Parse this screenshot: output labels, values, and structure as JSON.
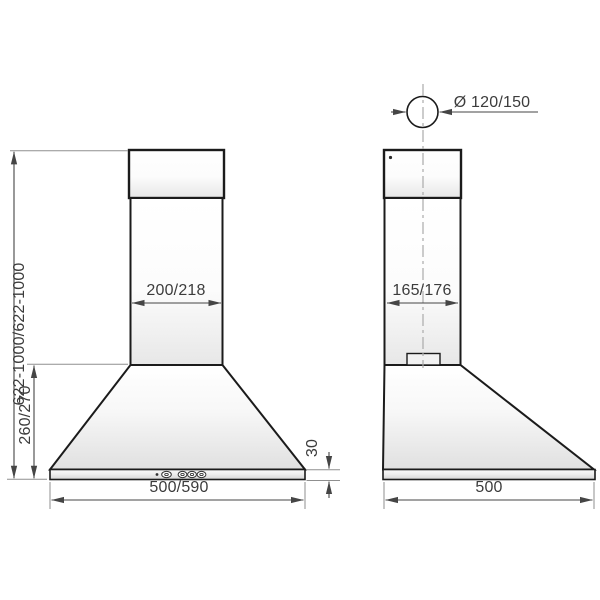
{
  "front_view": {
    "dimensions": {
      "total_height": "622-1000/622-1000",
      "hood_height": "260/270",
      "chimney_width": "200/218",
      "body_width": "500/590",
      "base_height": "30"
    },
    "controls": {
      "icons": [
        "power-dot",
        "light-button",
        "speed-button-1",
        "speed-button-2",
        "speed-button-3"
      ]
    }
  },
  "side_view": {
    "dimensions": {
      "duct_diameter": "Ø 120/150",
      "chimney_depth": "165/176",
      "body_depth": "500"
    }
  },
  "colors": {
    "object_line": "#1b1b1b",
    "dimension_line": "#454545",
    "extension_line": "#8f8f8f",
    "centerline": "#aaaaaa",
    "label_text": "#3c3c3c",
    "fill_highlight": "#ffffff",
    "fill_shade": "#e3e3e3"
  }
}
